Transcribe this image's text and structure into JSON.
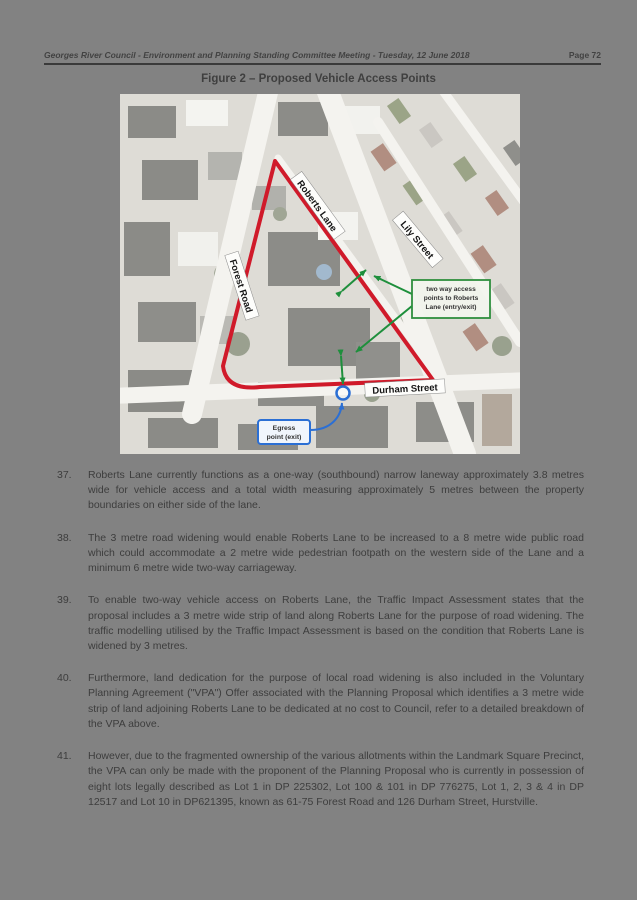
{
  "header": {
    "left": "Georges River Council - Environment and Planning Standing Committee Meeting - Tuesday, 12 June 2018",
    "right": "Page 72"
  },
  "figure_title": "Figure 2 – Proposed Vehicle Access Points",
  "map": {
    "labels": {
      "roberts_lane": "Roberts Lane",
      "forest_road": "Forest Road",
      "lily_street": "Lily Street",
      "durham_street": "Durham Street"
    },
    "annotations": {
      "green": [
        "two way access",
        "points to Roberts",
        "Lane (entry/exit)"
      ],
      "blue": [
        "Egress",
        "point (exit)"
      ]
    },
    "colors": {
      "site_boundary": "#d01a2a",
      "access_arrows": "#1e8f3c",
      "egress_marker": "#2b6fd4"
    }
  },
  "paragraphs": [
    {
      "num": "37.",
      "text": "Roberts Lane currently functions as a one-way (southbound) narrow laneway approximately 3.8 metres wide for vehicle access and a total width measuring approximately 5 metres between the property boundaries on either side of the lane."
    },
    {
      "num": "38.",
      "text": "The 3 metre road widening would enable Roberts Lane to be increased to a 8 metre wide public road which could accommodate a 2 metre wide pedestrian footpath on the western side of the Lane and a minimum 6 metre wide two-way carriageway."
    },
    {
      "num": "39.",
      "text": "To enable two-way vehicle access on Roberts Lane, the Traffic Impact Assessment states that the proposal includes a 3 metre wide strip of land along Roberts Lane for the purpose of road widening. The traffic modelling utilised by the Traffic Impact Assessment is based on the condition that Roberts Lane is widened by 3 metres."
    },
    {
      "num": "40.",
      "text": "Furthermore, land dedication for the purpose of local road widening is also included in the Voluntary Planning Agreement (\"VPA\") Offer associated with the Planning Proposal which identifies a 3 metre wide strip of land adjoining Roberts Lane to be dedicated at no cost to Council, refer to a detailed breakdown of the VPA above."
    },
    {
      "num": "41.",
      "text": "However, due to the fragmented ownership of the various allotments within the Landmark Square Precinct, the VPA can only be made with the proponent of the Planning Proposal who is currently in possession of eight lots legally described as Lot 1 in DP 225302, Lot 100 & 101 in DP 776275, Lot 1, 2, 3 & 4 in DP 12517 and Lot 10 in DP621395, known as 61-75 Forest Road and 126 Durham Street, Hurstville."
    }
  ]
}
